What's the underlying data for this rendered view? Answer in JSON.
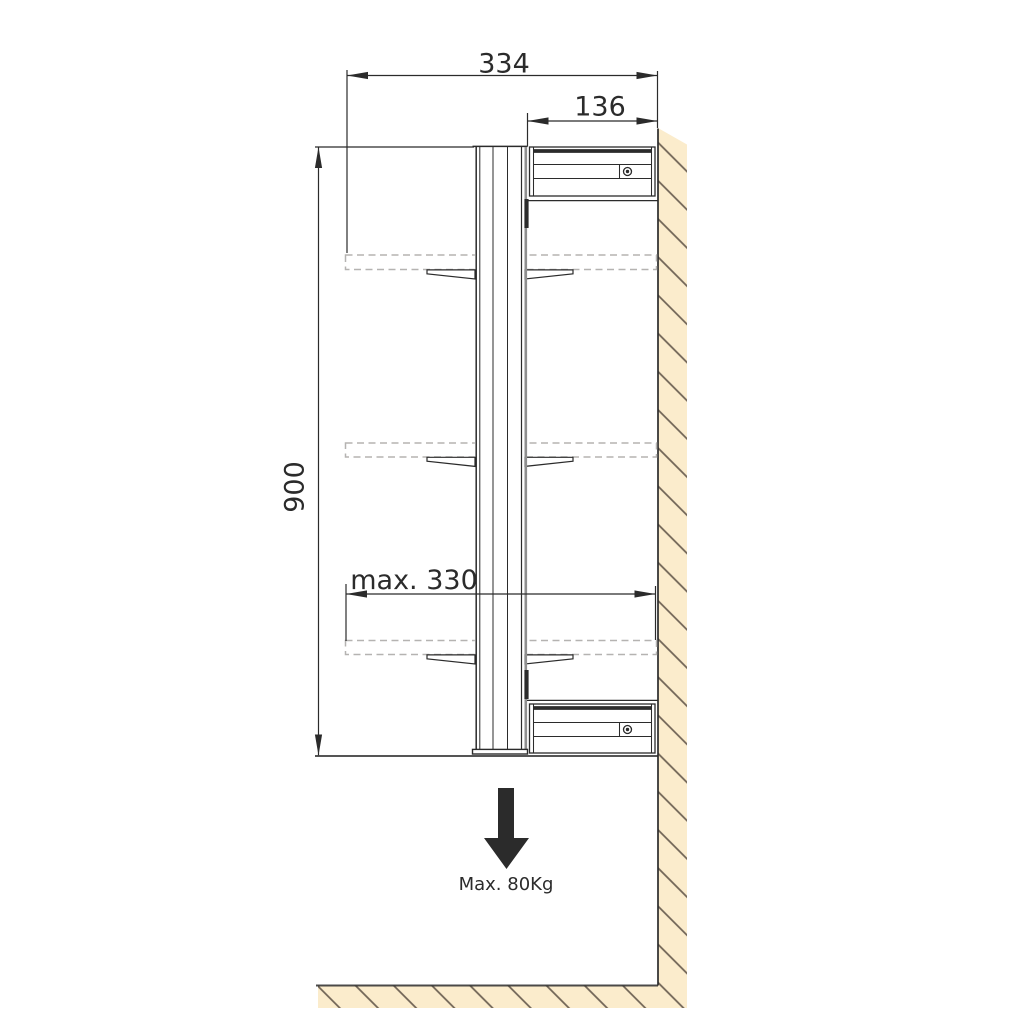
{
  "labels": {
    "overall_depth": "334",
    "bracket_depth": "136",
    "overall_height": "900",
    "max_shelf_width": "max. 330",
    "max_load": "Max. 80Kg"
  },
  "colors": {
    "background": "#ffffff",
    "line": "#2b2b2b",
    "dashed": "#b5b3b1",
    "wall_fill": "#fbeccc",
    "hatch_line": "#6f6355",
    "rail_gray": "#8f8f8f"
  },
  "icons": {
    "load_direction": "down-arrow",
    "bracket_fasteners": "screw-head"
  }
}
